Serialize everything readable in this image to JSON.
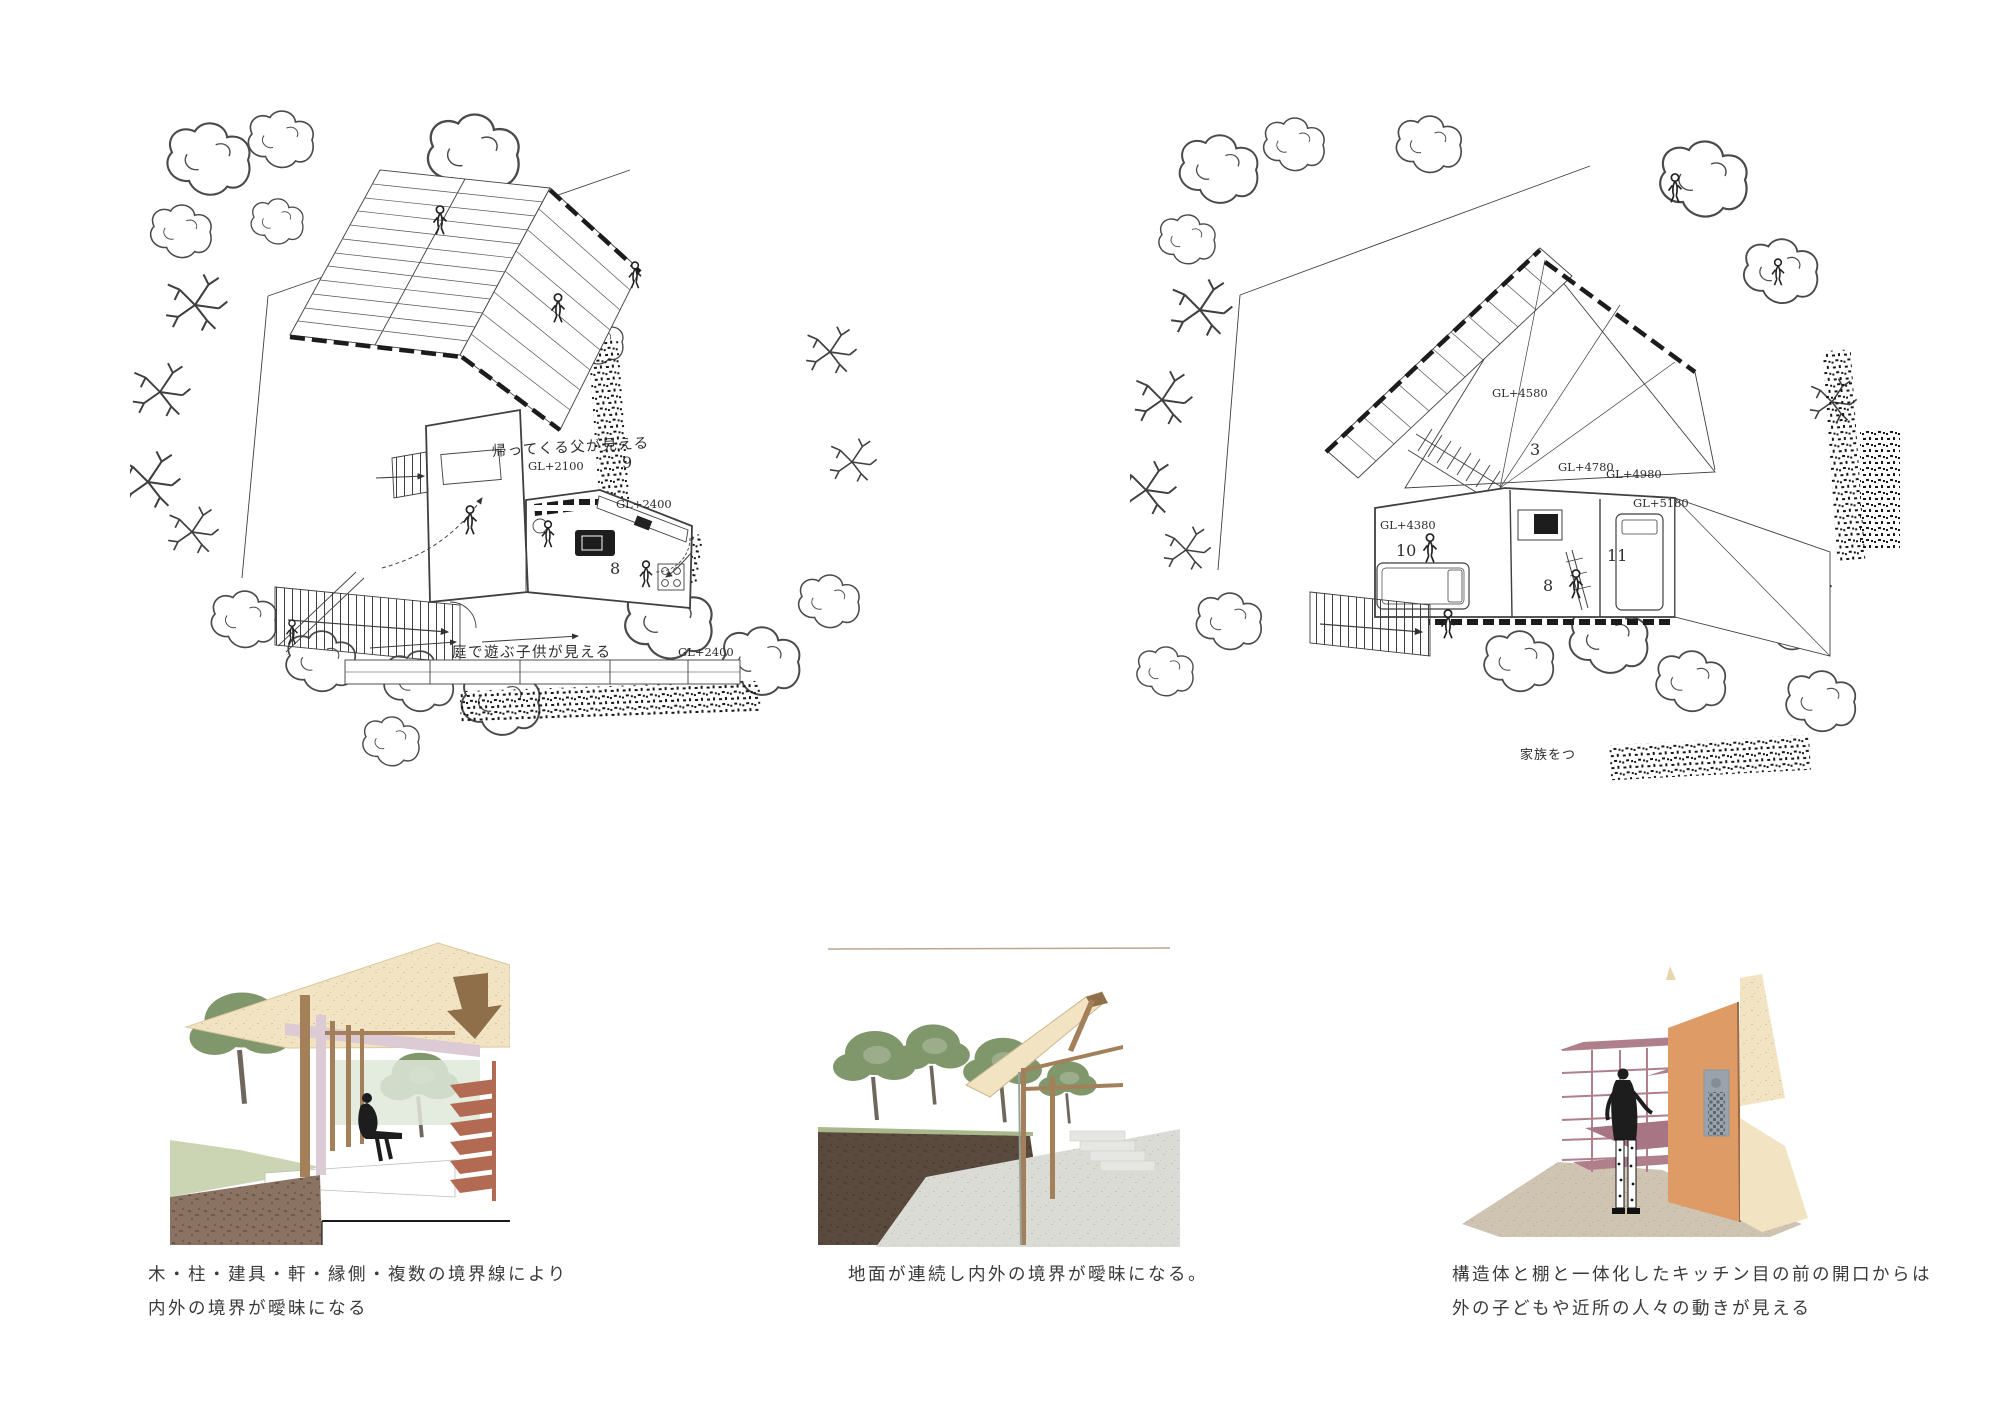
{
  "board": {
    "background": "#ffffff"
  },
  "plans": {
    "left": {
      "labels": {
        "coming_home": "帰ってくる父が見える",
        "gl2100": "GL+2100",
        "room9": "9",
        "gl2400_upper": "GL+2400",
        "room8": "8",
        "garden_children": "庭で遊ぶ子供が見える",
        "gl2400_lower": "GL+2400"
      }
    },
    "right": {
      "labels": {
        "gl4580": "GL+4580",
        "room3": "3",
        "gl4780": "GL+4780",
        "gl4980": "GL+4980",
        "gl5180": "GL+5180",
        "gl4380": "GL+4380",
        "room10": "10",
        "room8": "8",
        "room11": "11",
        "family_fragment": "家族をつ"
      }
    }
  },
  "captions": [
    {
      "line1": "木・柱・建具・軒・縁側・複数の境界線により",
      "line2": "内外の境界が曖昧になる"
    },
    {
      "line1": "地面が連続し内外の境界が曖昧になる。",
      "line2": ""
    },
    {
      "line1": "構造体と棚と一体化したキッチン目の前の開口からは",
      "line2": "外の子どもや近所の人々の動きが見える"
    }
  ],
  "colors": {
    "line": "#3f3f3f",
    "roof_cream": "#f2e4c2",
    "wood_brown": "#a3805a",
    "wood_brown_dark": "#8f6f4a",
    "pink_beam": "#dccbd4",
    "mauve_shelf": "#b07f8c",
    "mauve_shelf_dark": "#a87585",
    "terracotta_stair": "#b26a52",
    "orange_wall": "#de9b66",
    "soil_brown": "#8a7363",
    "soil_dark": "#594a3d",
    "tree_green": "#80966b",
    "ground_green": "#cbd5b3",
    "ground_green_strip": "#a9b88a",
    "ground_gray": "#dbdbd6",
    "floor_taupe": "#cfc3b1",
    "window_gray": "#9aa3ab",
    "glass_green": "#dfe8d9",
    "figure_black": "#1d1d1d"
  }
}
